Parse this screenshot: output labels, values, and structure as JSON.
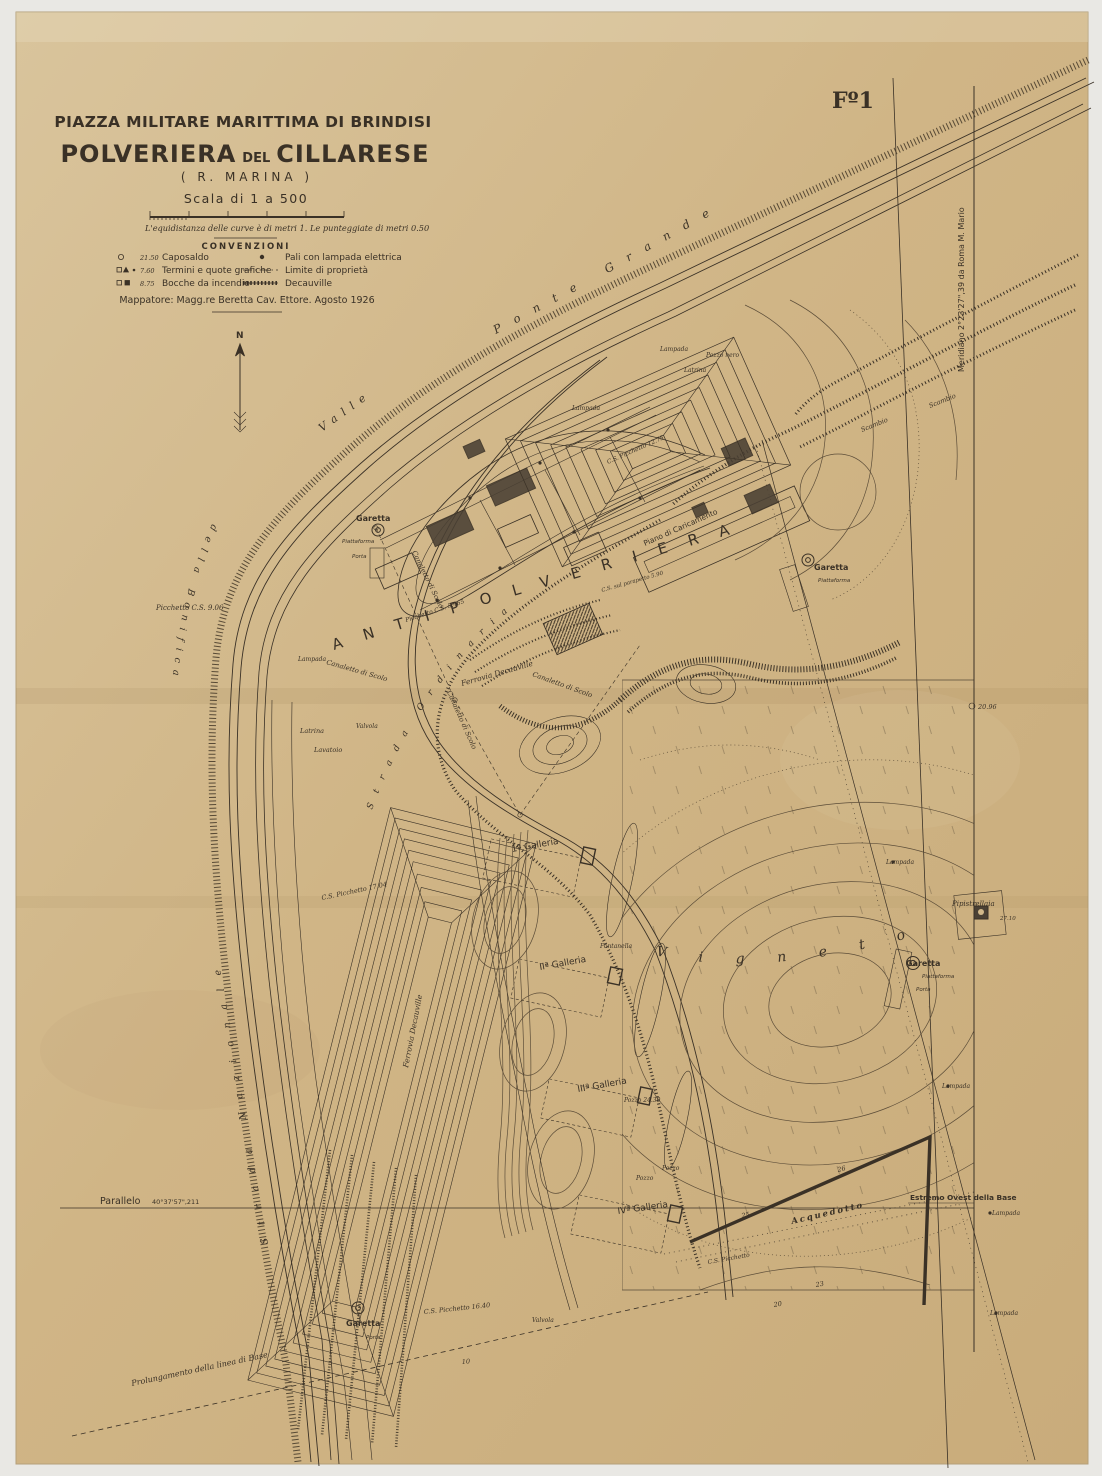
{
  "sheet": {
    "number": "Fº1"
  },
  "title_block": {
    "piazza": "PIAZZA MILITARE MARITTIMA DI BRINDISI",
    "line2_a": "POLVERIERA",
    "line2_b": "DEL",
    "line2_c": "CILLARESE",
    "r_marina": "( R. MARINA )",
    "scala": "Scala di 1 a 500",
    "equidistanza": "L'equidistanza delle curve è di metri 1. Le punteggiate di metri 0.50",
    "convenzioni": "CONVENZIONI",
    "mappatore": "Mappatore: Magg.re Beretta Cav. Ettore. Agosto 1926"
  },
  "legend": {
    "items": [
      {
        "symbol": "caposaldo-circle",
        "value": "21.50",
        "label": "Caposaldo"
      },
      {
        "symbol": "termini-marks",
        "value": "7.60",
        "label": "Termini e quote grafiche"
      },
      {
        "symbol": "bocche-squares",
        "value": "8.75",
        "label": "Bocche da incendio"
      },
      {
        "symbol": "palo-dot",
        "value": "",
        "label": "Pali con lampada elettrica"
      },
      {
        "symbol": "limite-dashdot",
        "value": "",
        "label": "Limite di proprietà"
      },
      {
        "symbol": "decauville-track",
        "value": "",
        "label": "Decauville"
      }
    ]
  },
  "compass": {
    "north": "N"
  },
  "georef": {
    "meridiano": "Meridiano 2°23'27\",39 da Roma M. Mario",
    "parallelo": "Parallelo",
    "parallelo_value": "40°37'57\",211",
    "prolungamento": "Prolungamento della linea di Base",
    "estremo_ovest": "Estremo Ovest della Base"
  },
  "labels": {
    "valle": "Valle",
    "ponte_grande": "Ponte Grande",
    "strada_nazionale": "Strada Nazionale",
    "della_bonifica": "della Bonifica",
    "strada_ordinaria": "Strada Ordinaria",
    "antipolveriera": "ANTIPOLVERIERA",
    "vigneto": "Vigneto",
    "piano_caricamento": "Piano di Caricamento",
    "ferrovia_decauville": "Ferrovia Decauville",
    "canaletto": "Canaletto di Scolo",
    "acquedotto": "Acquedotto",
    "garetta": "Garetta",
    "piattaforma": "Piattaforma",
    "porta": "Porta",
    "latrina": "Latrina",
    "lavatoio": "Lavatoio",
    "valvola": "Valvola",
    "lampada": "Lampada",
    "pozzo_nero": "Pozzo nero",
    "scambio": "Scambio",
    "galleria_1": "1ª Galleria",
    "galleria_2": "IIª Galleria",
    "galleria_3": "IIIª Galleria",
    "galleria_4": "IVª Galleria",
    "fontanella": "Fontanella",
    "pozzo": "Pozzo",
    "pozzo_24_30": "Pozzo 24.30",
    "picchetto_cs_9_06": "Picchetto C.S. 9.06",
    "picchetto_cs_5_465": "Picchetto C.S. 5.465",
    "cs_picchetto_12_75": "C.S. Picchetto 12.75",
    "cs_picchetto_17_04": "C.S. Picchetto 17.04",
    "cs_picchetto_16_40": "C.S. Picchetto 16.40",
    "cs_picchetto": "C.S. Picchetto",
    "cs_parapetto": "C.S. sul parapetto 5.90",
    "pipistrellaia": "Pipistrellaia",
    "quota_27_10": "27.10",
    "quota_20_96": "20.96",
    "c10": "10",
    "c20": "20",
    "c23": "23",
    "c25": "25",
    "c26": "26"
  },
  "colors": {
    "paper": "#d2b88a",
    "ink": "#3a3126",
    "scan_bg": "#e9e8e4"
  }
}
